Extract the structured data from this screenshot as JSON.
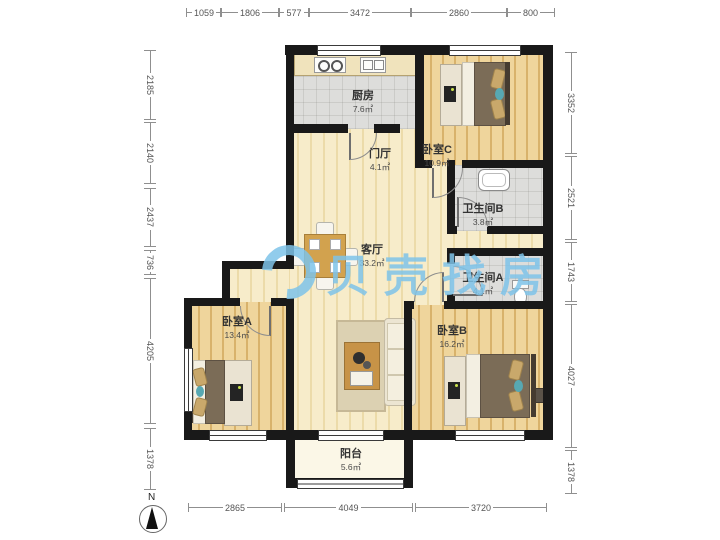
{
  "watermark": {
    "text": "贝壳找房",
    "color": "#7ec3e9"
  },
  "compass": {
    "label": "N"
  },
  "rooms": [
    {
      "id": "kitchen",
      "name": "厨房",
      "area": "7.6㎡"
    },
    {
      "id": "hall",
      "name": "门厅",
      "area": "4.1㎡"
    },
    {
      "id": "bedroomC",
      "name": "卧室C",
      "area": "10.9㎡"
    },
    {
      "id": "bathB",
      "name": "卫生间B",
      "area": "3.8㎡"
    },
    {
      "id": "living",
      "name": "客厅",
      "area": "33.2㎡"
    },
    {
      "id": "bathA",
      "name": "卫生间A",
      "area": "4.1㎡"
    },
    {
      "id": "bedroomA",
      "name": "卧室A",
      "area": "13.4㎡"
    },
    {
      "id": "bedroomB",
      "name": "卧室B",
      "area": "16.2㎡"
    },
    {
      "id": "balcony",
      "name": "阳台",
      "area": "5.6㎡"
    }
  ],
  "dimensions": {
    "top": [
      "1059",
      "1806",
      "577",
      "3472",
      "2860",
      "800"
    ],
    "left": [
      "2185",
      "2140",
      "2437",
      "736",
      "4205",
      "1378"
    ],
    "right": [
      "3352",
      "2521",
      "1743",
      "4027",
      "1378"
    ],
    "bottom": [
      "2865",
      "4049",
      "3720"
    ]
  }
}
